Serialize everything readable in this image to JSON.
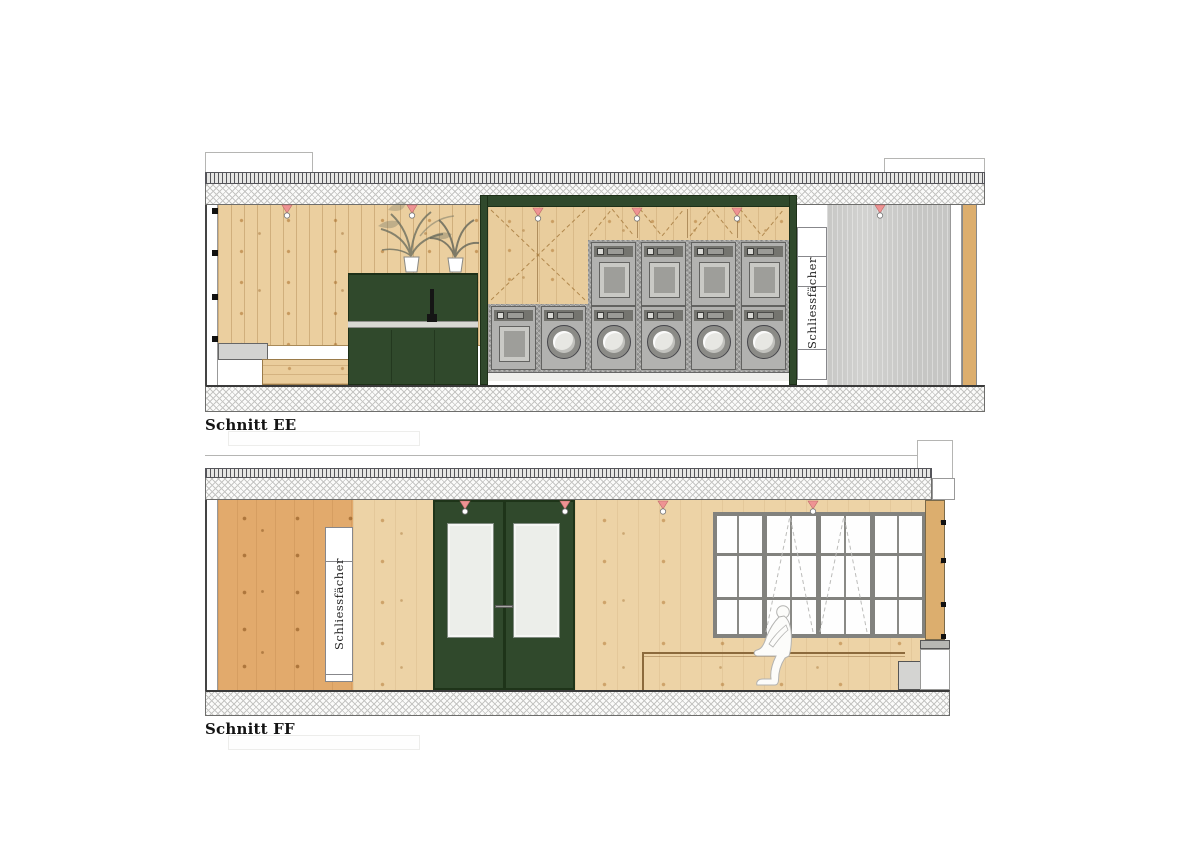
{
  "sections": {
    "ee": {
      "title": "Schnitt EE",
      "locker_label": "Schliessfächer"
    },
    "ff": {
      "title": "Schnitt FF",
      "locker_label": "Schliessfächer"
    }
  },
  "colors": {
    "green_joinery": "#30492c",
    "wood_boards": "#ebcf9f",
    "wood_light": "#edd3a6",
    "wood_dark": "#e2aa6c",
    "concrete_wall": "#d2d2d0",
    "tile_surround": "#a0a09e",
    "machine_body": "#b2b2b0",
    "door_glass": "#eceeea",
    "sprinkler_pink": "#ee9393"
  },
  "fixtures": {
    "sprinklers_section_ee": 6,
    "sprinklers_section_ff": 4,
    "front_loading_washers": 5,
    "stacked_dryers_top_row": 4,
    "bottom_row_machines": 6,
    "door_leaves": 2,
    "window_bays": 4,
    "window_rows": 3
  },
  "icons": {
    "sprinkler": "sprinkler-icon",
    "plant": "potted-plant-icon",
    "person": "seated-person-figure",
    "faucet": "faucet-icon"
  }
}
